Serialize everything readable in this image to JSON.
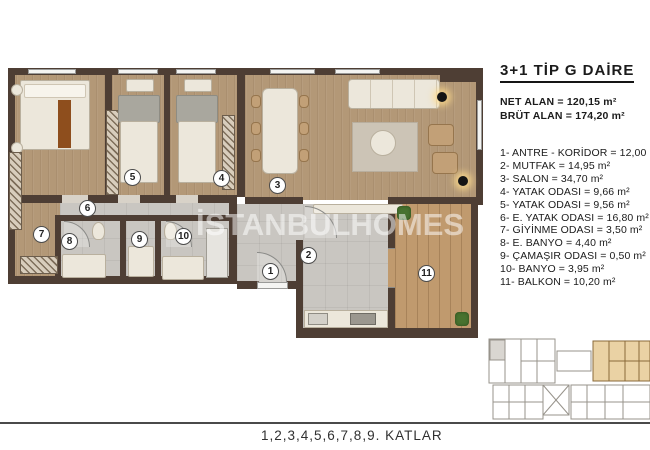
{
  "legend": {
    "title": "3+1 TİP G DAİRE",
    "net_area": "NET ALAN = 120,15 m²",
    "brut_area": "BRÜT ALAN = 174,20 m²",
    "items": [
      "1- ANTRE - KORİDOR = 12,00 m²",
      "2- MUTFAK = 14,95 m²",
      "3- SALON = 34,70 m²",
      "4- YATAK ODASI = 9,66 m²",
      "5- YATAK ODASI = 9,56 m²",
      "6- E. YATAK ODASI = 16,80 m²",
      "7- GİYİNME ODASI = 3,50 m²",
      "8- E. BANYO = 4,40 m²",
      "9- ÇAMAŞIR ODASI = 0,50 m²",
      "10- BANYO = 3,95 m²",
      "11- BALKON = 10,20 m²"
    ]
  },
  "plan": {
    "watermark": "İSTANBULHOMES",
    "rooms": [
      "1",
      "2",
      "3",
      "4",
      "5",
      "6",
      "7",
      "8",
      "9",
      "10",
      "11"
    ]
  },
  "footer": {
    "caption": "1,2,3,4,5,6,7,8,9. KATLAR"
  },
  "colors": {
    "wall": "#4e3e34",
    "wood": "#b39877",
    "deck": "#c09a6e",
    "tile": "#c9c6c1",
    "highlight": "#ead2a4"
  }
}
